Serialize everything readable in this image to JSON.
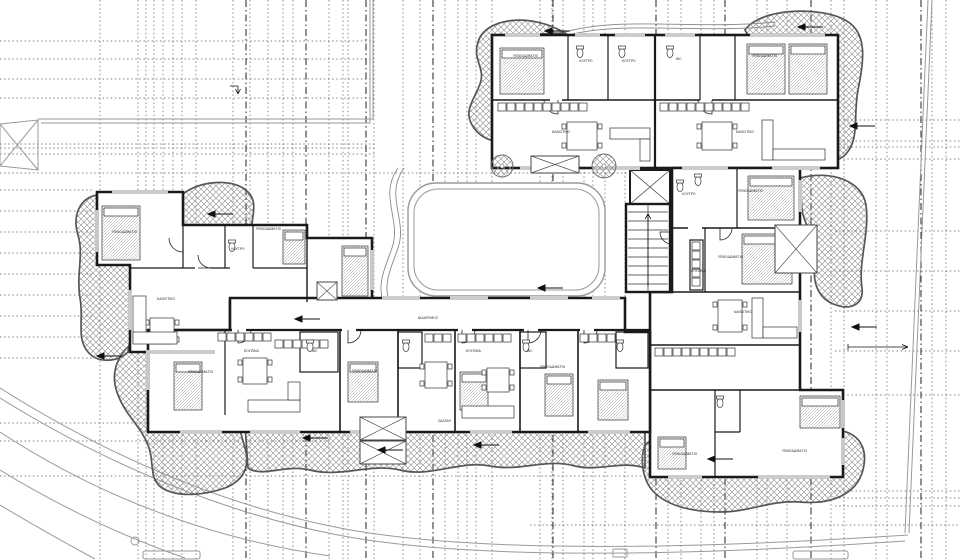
{
  "meta": {
    "drawing_type": "architectural floor plan — apartment building typical level",
    "language": "Greek"
  },
  "colors": {
    "walls": "#1a1a1a",
    "hatch": "#8a8a8a",
    "site_lines": "#9a9a9a",
    "grid_lines": "#3a3a3a"
  },
  "grid": {
    "vertical_x": [
      100,
      138,
      146,
      154,
      163,
      173,
      182,
      196,
      233,
      250,
      268,
      283,
      293,
      329,
      343,
      348,
      374,
      403,
      420,
      445,
      458,
      467,
      476,
      492,
      540,
      552,
      563,
      584,
      593,
      605,
      625,
      668,
      681,
      701,
      714,
      757,
      767,
      787,
      831,
      844,
      876,
      887,
      932,
      946
    ],
    "vertical_heavy_x": [
      246,
      306,
      366,
      433,
      553,
      656,
      725,
      811,
      921
    ],
    "h_left_top": {
      "x1": 0,
      "x2": 374,
      "y": [
        41,
        59,
        79,
        98,
        144,
        148,
        154,
        173
      ]
    },
    "h_left_strip": {
      "x1": 0,
      "x2": 93,
      "y": [
        190,
        211,
        232,
        253,
        274,
        295,
        316,
        337,
        358
      ]
    },
    "h_left_long": [
      {
        "y": 423,
        "x1": 0,
        "x2": 330
      },
      {
        "y": 441,
        "x1": 0,
        "x2": 330
      },
      {
        "y": 476,
        "x1": 0,
        "x2": 660
      }
    ],
    "h_right": {
      "x1": 835,
      "x2": 960,
      "y": [
        120,
        141,
        147,
        159,
        231,
        271,
        311,
        351,
        395,
        491,
        498,
        506
      ]
    },
    "h_bottom": {
      "x1": 530,
      "x2": 960,
      "y": [
        525
      ]
    },
    "h_courtyard": {
      "x1": 375,
      "x2": 660,
      "y": [
        173
      ]
    }
  },
  "labels": {
    "rooms": [
      {
        "t": "ΥΠΝΟΔΩΜΑΤΙΟ",
        "x": 513,
        "y": 57
      },
      {
        "t": "ΥΠΝΟΔΩΜΑΤΙΟ",
        "x": 752,
        "y": 57
      },
      {
        "t": "ΥΠΝΟΔΩΜΑΤΙΟ",
        "x": 112,
        "y": 233
      },
      {
        "t": "ΥΠΝΟΔΩΜΑΤΙΟ",
        "x": 256,
        "y": 230
      },
      {
        "t": "ΥΠΝΟΔΩΜΑΤΙΟ",
        "x": 738,
        "y": 192
      },
      {
        "t": "ΥΠΝΟΔΩΜΑΤΙΟ",
        "x": 718,
        "y": 258
      },
      {
        "t": "ΥΠΝΟΔΩΜΑΤΙΟ",
        "x": 188,
        "y": 373
      },
      {
        "t": "ΥΠΝΟΔΩΜΑΤΙΟ",
        "x": 352,
        "y": 372
      },
      {
        "t": "ΥΠΝΟΔΩΜΑΤΙΟ",
        "x": 540,
        "y": 368
      },
      {
        "t": "ΥΠΝΟΔΩΜΑΤΙΟ",
        "x": 672,
        "y": 455
      },
      {
        "t": "ΥΠΝΟΔΩΜΑΤΙΟ",
        "x": 782,
        "y": 452
      },
      {
        "t": "ΚΑΘΙΣΤΙΚΟ",
        "x": 552,
        "y": 133
      },
      {
        "t": "ΚΑΘΙΣΤΙΚΟ",
        "x": 736,
        "y": 133
      },
      {
        "t": "ΚΑΘΙΣΤΙΚΟ",
        "x": 157,
        "y": 300
      },
      {
        "t": "ΚΑΘΙΣΤΙΚΟ",
        "x": 734,
        "y": 313
      },
      {
        "t": "ΣΑΛΟΝΙ",
        "x": 438,
        "y": 422
      },
      {
        "t": "ΚΟΥΖΙΝΑ",
        "x": 244,
        "y": 352
      },
      {
        "t": "ΚΟΥΖΙΝΑ",
        "x": 466,
        "y": 352
      },
      {
        "t": "ΚΟΥΖΙΝΑ",
        "x": 691,
        "y": 272
      },
      {
        "t": "ΛΟΥΤΡΟ",
        "x": 579,
        "y": 62
      },
      {
        "t": "ΛΟΥΤΡΟ",
        "x": 622,
        "y": 62
      },
      {
        "t": "ΛΟΥΤΡΟ",
        "x": 231,
        "y": 250
      },
      {
        "t": "ΛΟΥΤΡΟ",
        "x": 682,
        "y": 195
      },
      {
        "t": "WC",
        "x": 676,
        "y": 60
      },
      {
        "t": "WC",
        "x": 312,
        "y": 352
      },
      {
        "t": "WC",
        "x": 527,
        "y": 352
      },
      {
        "t": "ΔΙΑΔΡΟΜΟΣ",
        "x": 418,
        "y": 319
      }
    ]
  },
  "arrows": [
    [
      208,
      214
    ],
    [
      545,
      31
    ],
    [
      798,
      27
    ],
    [
      850,
      126
    ],
    [
      852,
      327
    ],
    [
      303,
      438
    ],
    [
      378,
      450
    ],
    [
      474,
      445
    ],
    [
      708,
      459
    ],
    [
      97,
      356
    ],
    [
      295,
      319
    ],
    [
      538,
      288
    ]
  ],
  "furniture": {
    "beds": [
      [
        500,
        48,
        44,
        46
      ],
      [
        747,
        44,
        38,
        50
      ],
      [
        789,
        44,
        38,
        50
      ],
      [
        102,
        206,
        38,
        54
      ],
      [
        283,
        230,
        22,
        34
      ],
      [
        748,
        176,
        46,
        44
      ],
      [
        742,
        234,
        50,
        50
      ],
      [
        174,
        362,
        28,
        48
      ],
      [
        342,
        246,
        26,
        50
      ],
      [
        348,
        362,
        30,
        40
      ],
      [
        545,
        374,
        28,
        42
      ],
      [
        598,
        380,
        30,
        40
      ],
      [
        658,
        437,
        28,
        32
      ],
      [
        800,
        396,
        40,
        32
      ],
      [
        460,
        372,
        28,
        38
      ]
    ],
    "tables": [
      [
        567,
        122,
        30,
        28
      ],
      [
        702,
        122,
        30,
        28
      ],
      [
        150,
        318,
        24,
        26
      ],
      [
        243,
        358,
        24,
        26
      ],
      [
        425,
        362,
        22,
        26
      ],
      [
        487,
        368,
        22,
        24
      ],
      [
        718,
        300,
        24,
        32
      ]
    ],
    "sofas": [
      [
        610,
        128,
        40,
        11
      ],
      [
        640,
        139,
        10,
        22
      ],
      [
        762,
        120,
        11,
        40
      ],
      [
        773,
        149,
        52,
        11
      ],
      [
        133,
        296,
        13,
        46
      ],
      [
        133,
        332,
        44,
        12
      ],
      [
        752,
        298,
        11,
        40
      ],
      [
        763,
        327,
        34,
        11
      ],
      [
        248,
        400,
        52,
        12
      ],
      [
        288,
        382,
        12,
        18
      ],
      [
        462,
        406,
        52,
        12
      ]
    ],
    "counters": [
      {
        "x": 498,
        "y": 103,
        "n": 10
      },
      {
        "x": 660,
        "y": 103,
        "n": 10
      },
      {
        "x": 218,
        "y": 333,
        "n": 6
      },
      {
        "x": 425,
        "y": 334,
        "n": 3
      },
      {
        "x": 458,
        "y": 334,
        "n": 6
      },
      {
        "x": 580,
        "y": 334,
        "n": 4
      },
      {
        "x": 275,
        "y": 340,
        "n": 6
      },
      {
        "x": 655,
        "y": 348,
        "n": 9
      },
      {
        "x": 692,
        "y": 242,
        "n": 5,
        "v": true
      }
    ],
    "toilets": [
      [
        580,
        48
      ],
      [
        622,
        48
      ],
      [
        670,
        48
      ],
      [
        232,
        242
      ],
      [
        680,
        182
      ],
      [
        310,
        342
      ],
      [
        406,
        342
      ],
      [
        526,
        342
      ],
      [
        620,
        342
      ],
      [
        720,
        398
      ],
      [
        698,
        176
      ]
    ],
    "xboxes": [
      [
        531,
        156,
        48,
        17
      ],
      [
        317,
        282,
        20,
        18
      ],
      [
        360,
        417,
        46,
        23
      ],
      [
        360,
        441,
        46,
        23
      ],
      [
        775,
        225,
        42,
        48
      ]
    ],
    "trees": [
      [
        502,
        166,
        11
      ],
      [
        604,
        166,
        12
      ]
    ]
  },
  "windows": [
    {
      "o": "h",
      "y": 35,
      "a": 505,
      "b": 540
    },
    {
      "o": "h",
      "y": 35,
      "a": 575,
      "b": 600
    },
    {
      "o": "h",
      "y": 35,
      "a": 615,
      "b": 645
    },
    {
      "o": "h",
      "y": 35,
      "a": 665,
      "b": 695
    },
    {
      "o": "h",
      "y": 35,
      "a": 750,
      "b": 825
    },
    {
      "o": "h",
      "y": 168,
      "a": 520,
      "b": 558
    },
    {
      "o": "h",
      "y": 168,
      "a": 592,
      "b": 640
    },
    {
      "o": "h",
      "y": 168,
      "a": 682,
      "b": 728
    },
    {
      "o": "h",
      "y": 168,
      "a": 772,
      "b": 820
    },
    {
      "o": "v",
      "x": 800,
      "a": 180,
      "b": 212
    },
    {
      "o": "v",
      "x": 800,
      "a": 240,
      "b": 272
    },
    {
      "o": "v",
      "x": 800,
      "a": 300,
      "b": 332
    },
    {
      "o": "v",
      "x": 843,
      "a": 400,
      "b": 428
    },
    {
      "o": "v",
      "x": 843,
      "a": 438,
      "b": 465
    },
    {
      "o": "h",
      "y": 477,
      "a": 668,
      "b": 702
    },
    {
      "o": "h",
      "y": 477,
      "a": 758,
      "b": 830
    },
    {
      "o": "v",
      "x": 97,
      "a": 210,
      "b": 252
    },
    {
      "o": "h",
      "y": 192,
      "a": 112,
      "b": 168
    },
    {
      "o": "h",
      "y": 352,
      "a": 150,
      "b": 215
    },
    {
      "o": "v",
      "x": 372,
      "a": 250,
      "b": 290
    },
    {
      "o": "v",
      "x": 148,
      "a": 350,
      "b": 390
    },
    {
      "o": "v",
      "x": 130,
      "a": 290,
      "b": 330
    },
    {
      "o": "h",
      "y": 432,
      "a": 180,
      "b": 222
    },
    {
      "o": "h",
      "y": 432,
      "a": 250,
      "b": 300
    },
    {
      "o": "h",
      "y": 432,
      "a": 350,
      "b": 392
    },
    {
      "o": "h",
      "y": 432,
      "a": 470,
      "b": 512
    },
    {
      "o": "h",
      "y": 432,
      "a": 588,
      "b": 630
    },
    {
      "o": "h",
      "y": 298,
      "a": 382,
      "b": 420
    },
    {
      "o": "h",
      "y": 298,
      "a": 450,
      "b": 488
    },
    {
      "o": "h",
      "y": 298,
      "a": 530,
      "b": 568
    },
    {
      "o": "h",
      "y": 298,
      "a": 592,
      "b": 620
    }
  ],
  "doors": [
    {
      "d": "M238,330 v13 a13,13 0 0 0 13,-13"
    },
    {
      "d": "M348,330 v13 a13,13 0 0 0 13,-13"
    },
    {
      "d": "M462,330 v13 a13,13 0 0 0 13,-13"
    },
    {
      "d": "M528,330 v13 a13,13 0 0 0 13,-13"
    },
    {
      "d": "M584,330 v13 a13,13 0 0 0 13,-13"
    },
    {
      "d": "M558,100 v14 a14,14 0 0 1 -14,-14"
    },
    {
      "d": "M712,100 v14 a14,14 0 0 1 -14,-14"
    },
    {
      "d": "M198,268 h13 a13,13 0 0 1 -13,-13"
    },
    {
      "d": "M720,228 v12 a12,12 0 0 0 12,-12"
    },
    {
      "d": "M672,232 h-12 a12,12 0 0 0 12,12"
    },
    {
      "d": "M183,238 v14 a14,14 0 0 1 -14,-14"
    }
  ]
}
